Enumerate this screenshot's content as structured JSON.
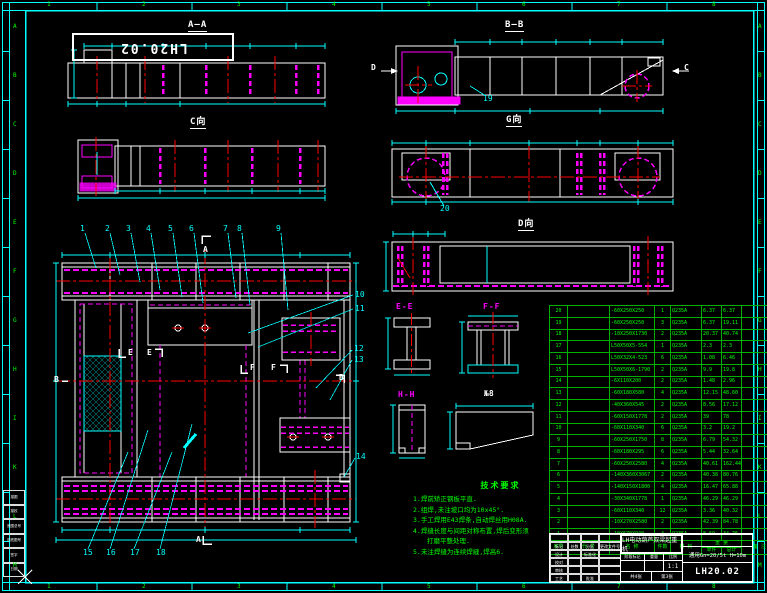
{
  "colors": {
    "background": "#000000",
    "frame_cyan": "#00ffff",
    "geometry_white": "#ffffff",
    "stiffener_magenta": "#ff00ff",
    "centerline_red": "#ff0000",
    "table_green": "#00ff00"
  },
  "sheet": {
    "corner_label": "LH20.02",
    "zone_numbers": [
      "1",
      "2",
      "3",
      "4",
      "5",
      "6",
      "7",
      "8"
    ],
    "zone_letters": [
      "A",
      "B",
      "C",
      "D",
      "E",
      "F",
      "G",
      "H",
      "I",
      "K",
      "L",
      "M"
    ]
  },
  "views": {
    "aa": {
      "label": "A—A"
    },
    "bb": {
      "label": "B—B",
      "arrow_left": "D",
      "arrow_right": "C",
      "callout": "19"
    },
    "c_view": {
      "label": "C向"
    },
    "g_view": {
      "label": "G向",
      "callout": "20"
    },
    "d_view": {
      "label": "D向"
    },
    "ee": {
      "label": "E-E"
    },
    "ff": {
      "label": "F-F"
    },
    "hh": {
      "label": "H-H"
    },
    "wedge": {
      "label": "№8"
    },
    "main": {
      "section_a": "A",
      "section_b": "B",
      "section_e": "E",
      "section_f": "F"
    }
  },
  "callouts": [
    "1",
    "2",
    "3",
    "4",
    "5",
    "6",
    "7",
    "8",
    "9",
    "10",
    "11",
    "12",
    "13",
    "14",
    "15",
    "16",
    "17",
    "18",
    "19",
    "20"
  ],
  "tech_req": {
    "title": "技术要求",
    "items": [
      "1.焊前矫正钢板平直.",
      "2.组焊,未注坡口均为10x45°.",
      "3.手工焊用E43焊条,自动焊丝用H08A.",
      "4.焊缝长度与间距对称布置,焊后变形须",
      "打磨平整处理.",
      "5.未注焊缝为连续焊缝,焊高6."
    ]
  },
  "bom": {
    "headers": {
      "seq": "序号",
      "code": "代 号",
      "name": "名 称",
      "qty": "件数",
      "material": "材 料",
      "weight": "重 量",
      "unit": "单件",
      "total": "总计",
      "remark": "备 注"
    },
    "rows": [
      {
        "no": "20",
        "code": "",
        "name": "-60X250X250",
        "qty": "1",
        "mat": "Q235A",
        "unit": "6.37",
        "total": "6.37",
        "rem": ""
      },
      {
        "no": "19",
        "code": "",
        "name": "-60X250X250",
        "qty": "3",
        "mat": "Q235A",
        "unit": "6.37",
        "total": "19.11",
        "rem": ""
      },
      {
        "no": "18",
        "code": "",
        "name": "-10X250X1730",
        "qty": "2",
        "mat": "Q235A",
        "unit": "20.37",
        "total": "40.74",
        "rem": ""
      },
      {
        "no": "17",
        "code": "",
        "name": "L50X50X5-554",
        "qty": "1",
        "mat": "Q235A",
        "unit": "2.3",
        "total": "2.3",
        "rem": ""
      },
      {
        "no": "16",
        "code": "",
        "name": "L50X32X4-523",
        "qty": "6",
        "mat": "Q235A",
        "unit": "1.08",
        "total": "6.46",
        "rem": ""
      },
      {
        "no": "15",
        "code": "",
        "name": "L50X50X6-1790",
        "qty": "2",
        "mat": "Q235A",
        "unit": "9.9",
        "total": "19.8",
        "rem": ""
      },
      {
        "no": "14",
        "code": "",
        "name": "-6X110X200",
        "qty": "2",
        "mat": "Q235A",
        "unit": "1.48",
        "total": "2.96",
        "rem": ""
      },
      {
        "no": "13",
        "code": "",
        "name": "-60X180X580",
        "qty": "4",
        "mat": "Q235A",
        "unit": "12.15",
        "total": "48.60",
        "rem": ""
      },
      {
        "no": "12",
        "code": "",
        "name": "-40X360X545",
        "qty": "2",
        "mat": "Q235A",
        "unit": "8.56",
        "total": "17.12",
        "rem": ""
      },
      {
        "no": "11",
        "code": "",
        "name": "-60X150X1778",
        "qty": "2",
        "mat": "Q235A",
        "unit": "39",
        "total": "78",
        "rem": ""
      },
      {
        "no": "10",
        "code": "",
        "name": "-60X110X340",
        "qty": "6",
        "mat": "Q235A",
        "unit": "3.2",
        "total": "19.2",
        "rem": ""
      },
      {
        "no": "9",
        "code": "",
        "name": "-60X250X1750",
        "qty": "8",
        "mat": "Q235A",
        "unit": "6.79",
        "total": "54.32",
        "rem": ""
      },
      {
        "no": "8",
        "code": "",
        "name": "-60X180X295",
        "qty": "6",
        "mat": "Q235A",
        "unit": "5.44",
        "total": "32.64",
        "rem": ""
      },
      {
        "no": "7",
        "code": "",
        "name": "-60X250X2580",
        "qty": "4",
        "mat": "Q235A",
        "unit": "40.61",
        "total": "162.44",
        "rem": ""
      },
      {
        "no": "6",
        "code": "",
        "name": "-140X360X3067",
        "qty": "2",
        "mat": "Q235A",
        "unit": "40.38",
        "total": "80.76",
        "rem": ""
      },
      {
        "no": "5",
        "code": "",
        "name": "-140X150X1800",
        "qty": "4",
        "mat": "Q235A",
        "unit": "16.47",
        "total": "65.88",
        "rem": ""
      },
      {
        "no": "4",
        "code": "",
        "name": "-30X340X1778",
        "qty": "1",
        "mat": "Q235A",
        "unit": "46.29",
        "total": "46.29",
        "rem": ""
      },
      {
        "no": "3",
        "code": "",
        "name": "-60X110X340",
        "qty": "12",
        "mat": "Q235A",
        "unit": "3.36",
        "total": "40.32",
        "rem": ""
      },
      {
        "no": "2",
        "code": "",
        "name": "-10X270X2580",
        "qty": "2",
        "mat": "Q235A",
        "unit": "42.39",
        "total": "84.78",
        "rem": ""
      },
      {
        "no": "1",
        "code": "",
        "name": "-10X670X940",
        "qty": "4",
        "mat": "Q235A",
        "unit": "8.69",
        "total": "34.76",
        "rem": ""
      }
    ]
  },
  "title_block": {
    "title": "LH电动葫芦双梁起重机",
    "spec": "通用Gn=20/5t H=10m",
    "drawing_no": "LH20.02",
    "stage_label": "阶段标记",
    "weight_label": "重量",
    "scale_label": "比例",
    "scale": "1:1",
    "sheets_label": "共4张",
    "sheet_no_label": "第3张",
    "left_cells": [
      [
        "",
        "",
        "",
        ""
      ],
      [
        "标记",
        "处数",
        "分区",
        "更改文件号"
      ],
      [
        "设计",
        "",
        "标准化",
        ""
      ],
      [
        "校对",
        "",
        "",
        ""
      ],
      [
        "审核",
        "",
        "",
        ""
      ],
      [
        "工艺",
        "",
        "批准",
        ""
      ]
    ]
  },
  "margin_table": {
    "rows": [
      "描图",
      "描校",
      "底图总号",
      "旧底图号",
      "签字",
      "日期"
    ]
  }
}
